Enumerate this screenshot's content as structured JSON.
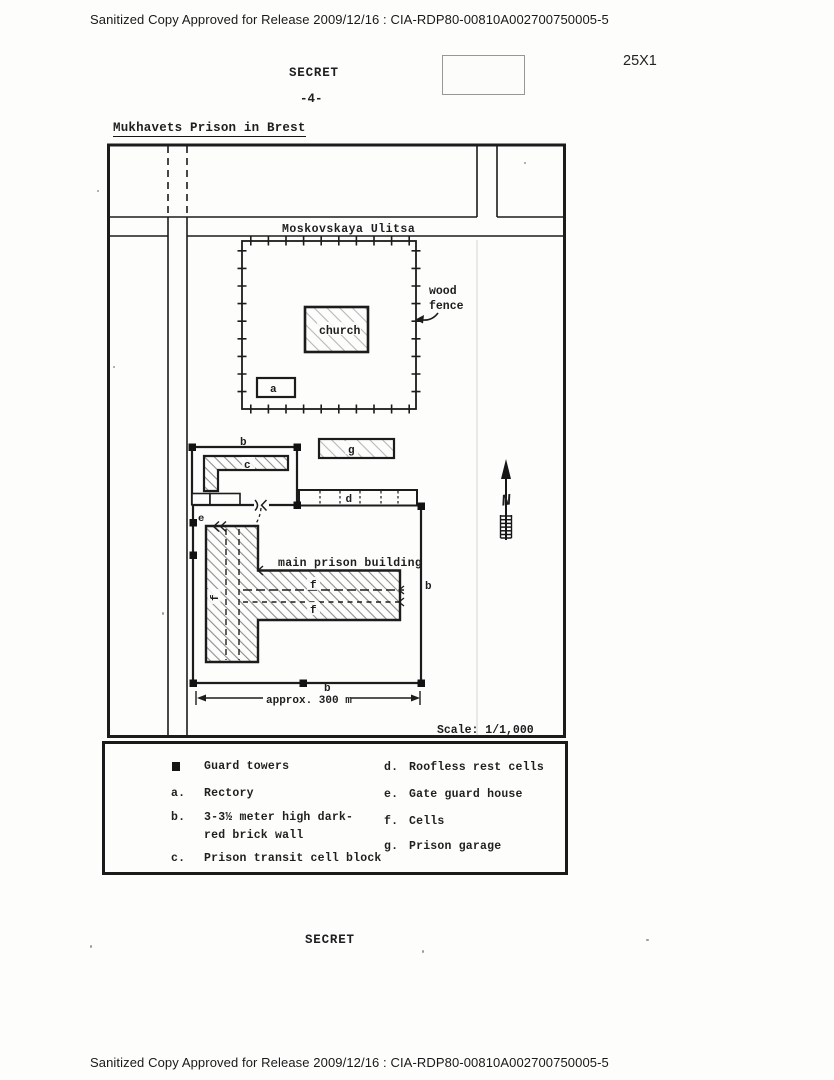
{
  "document": {
    "header": "Sanitized Copy Approved for Release 2009/12/16 : CIA-RDP80-00810A002700750005-5",
    "classification_top": "SECRET",
    "page_number": "-4-",
    "marginal_code": "25X1",
    "title": "Mukhavets Prison in Brest",
    "classification_bottom": "SECRET",
    "footer": "Sanitized Copy Approved for Release 2009/12/16 : CIA-RDP80-00810A002700750005-5"
  },
  "map": {
    "street_name": "Moskovskaya Ulitsa",
    "church_label": "church",
    "wood_fence": {
      "line1": "wood",
      "line2": "fence"
    },
    "main_building_label": "main prison building",
    "dimension_label": "approx. 300 m",
    "scale_label": "Scale: 1/1,000",
    "north_letter": "N",
    "markers": {
      "a": "a",
      "b": "b",
      "c": "c",
      "d": "d",
      "e": "e",
      "f": "f",
      "g": "g"
    }
  },
  "legend": {
    "guard_towers": {
      "symbol": "■",
      "label": "Guard towers"
    },
    "left": [
      {
        "key": "a.",
        "lines": [
          "Rectory"
        ]
      },
      {
        "key": "b.",
        "lines": [
          "3-3½ meter high dark-",
          "red brick wall"
        ]
      },
      {
        "key": "c.",
        "lines": [
          "Prison transit cell block"
        ]
      }
    ],
    "right": [
      {
        "key": "d.",
        "lines": [
          "Roofless rest cells"
        ]
      },
      {
        "key": "e.",
        "lines": [
          "Gate guard house"
        ]
      },
      {
        "key": "f.",
        "lines": [
          "Cells"
        ]
      },
      {
        "key": "g.",
        "lines": [
          "Prison garage"
        ]
      }
    ]
  }
}
